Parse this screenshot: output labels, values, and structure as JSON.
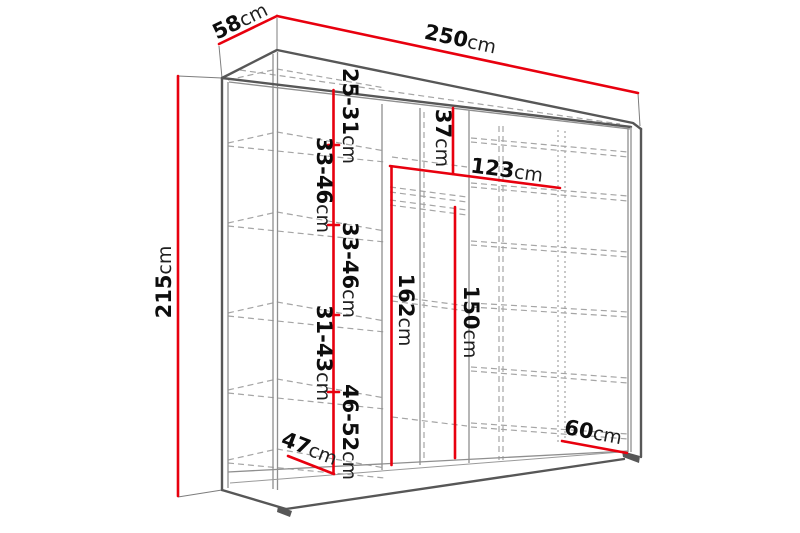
{
  "diagram": {
    "kind": "wardrobe-dimension-diagram",
    "unit": "cm",
    "colors": {
      "dimension_line": "#e8000e",
      "outline": "#575757",
      "interior_line": "#8f8f8f",
      "dashed_line": "#a5a5a5",
      "text": "#0d0d0d",
      "background": "#ffffff"
    }
  },
  "labels": {
    "depth": {
      "num": "58",
      "unit": "cm"
    },
    "width": {
      "num": "250",
      "unit": "cm"
    },
    "height": {
      "num": "215",
      "unit": "cm"
    },
    "left_seg1": {
      "num": "25-31",
      "unit": "cm"
    },
    "left_seg2": {
      "num": "33-46",
      "unit": "cm"
    },
    "left_seg3": {
      "num": "33-46",
      "unit": "cm"
    },
    "left_seg4": {
      "num": "31-43",
      "unit": "cm"
    },
    "left_seg5": {
      "num": "46-52",
      "unit": "cm"
    },
    "rail_length": {
      "num": "123",
      "unit": "cm"
    },
    "top_gap": {
      "num": "37",
      "unit": "cm"
    },
    "mid_height": {
      "num": "162",
      "unit": "cm"
    },
    "right_height": {
      "num": "150",
      "unit": "cm"
    },
    "bottom_width": {
      "num": "60",
      "unit": "cm"
    },
    "bottom_depth": {
      "num": "47",
      "unit": "cm"
    }
  }
}
